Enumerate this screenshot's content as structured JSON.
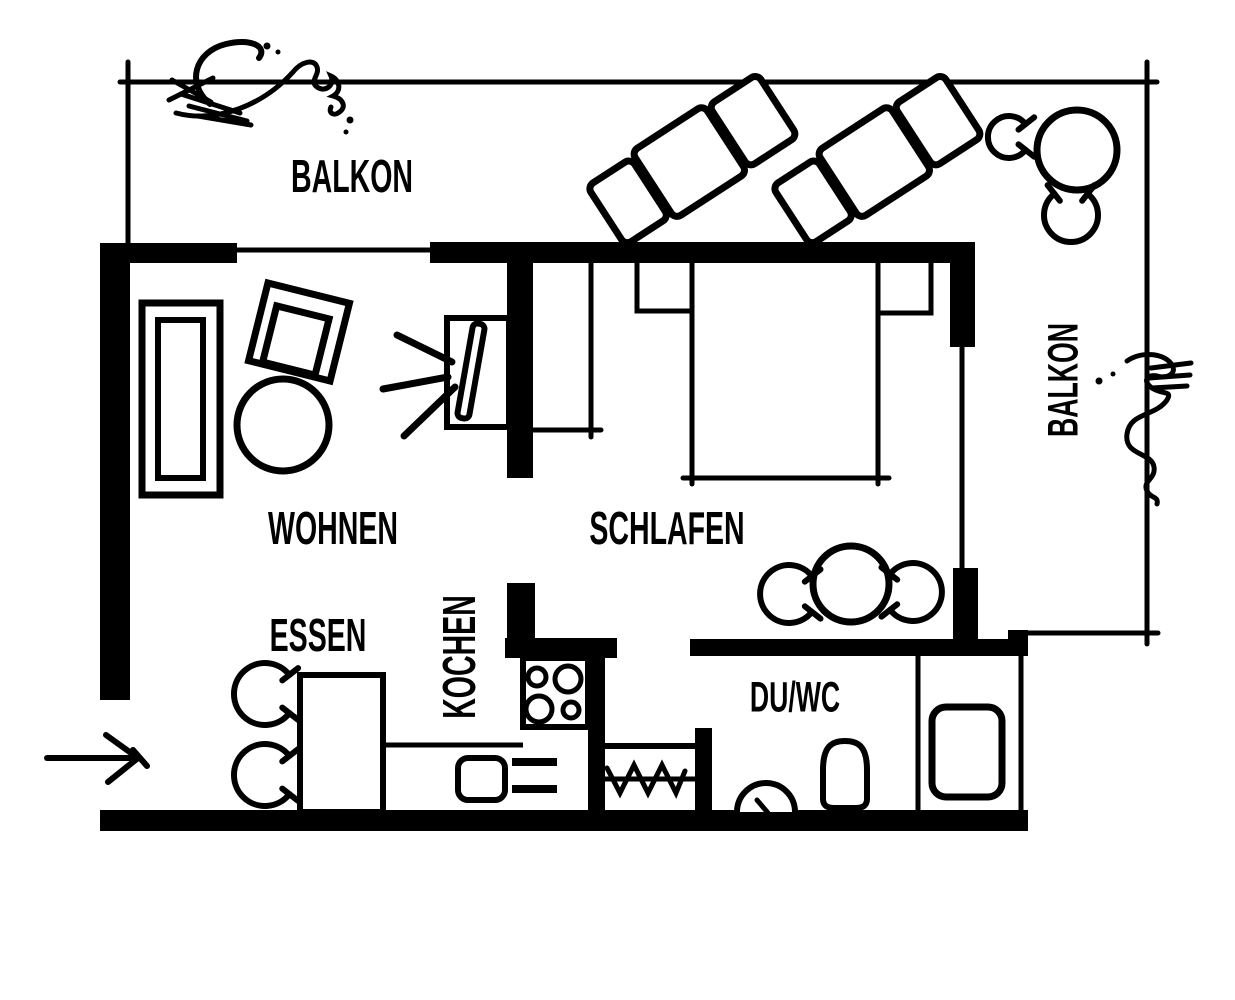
{
  "colors": {
    "ink": "#000000",
    "background": "#ffffff"
  },
  "plan": {
    "type": "apartment-floor-plan",
    "rooms": {
      "balcony_top": {
        "label": "BALKON"
      },
      "balcony_right": {
        "label": "BALKON"
      },
      "living": {
        "label": "WOHNEN"
      },
      "sleeping": {
        "label": "SCHLAFEN"
      },
      "dining": {
        "label": "ESSEN"
      },
      "kitchen": {
        "label": "KOCHEN"
      },
      "bathroom": {
        "label": "DU/WC"
      }
    },
    "symbols": [
      "entrance-arrow",
      "sofa",
      "armchair",
      "coffee-table",
      "tv-cabinet",
      "double-bed",
      "nightstand",
      "wardrobe",
      "round-table",
      "chair-arc",
      "dining-table",
      "stove",
      "kitchen-sink",
      "kitchen-drawers",
      "closet-hangers",
      "toilet",
      "washbasin",
      "shower-tray",
      "sun-lounger",
      "balcony-table",
      "plant-scribble"
    ]
  }
}
